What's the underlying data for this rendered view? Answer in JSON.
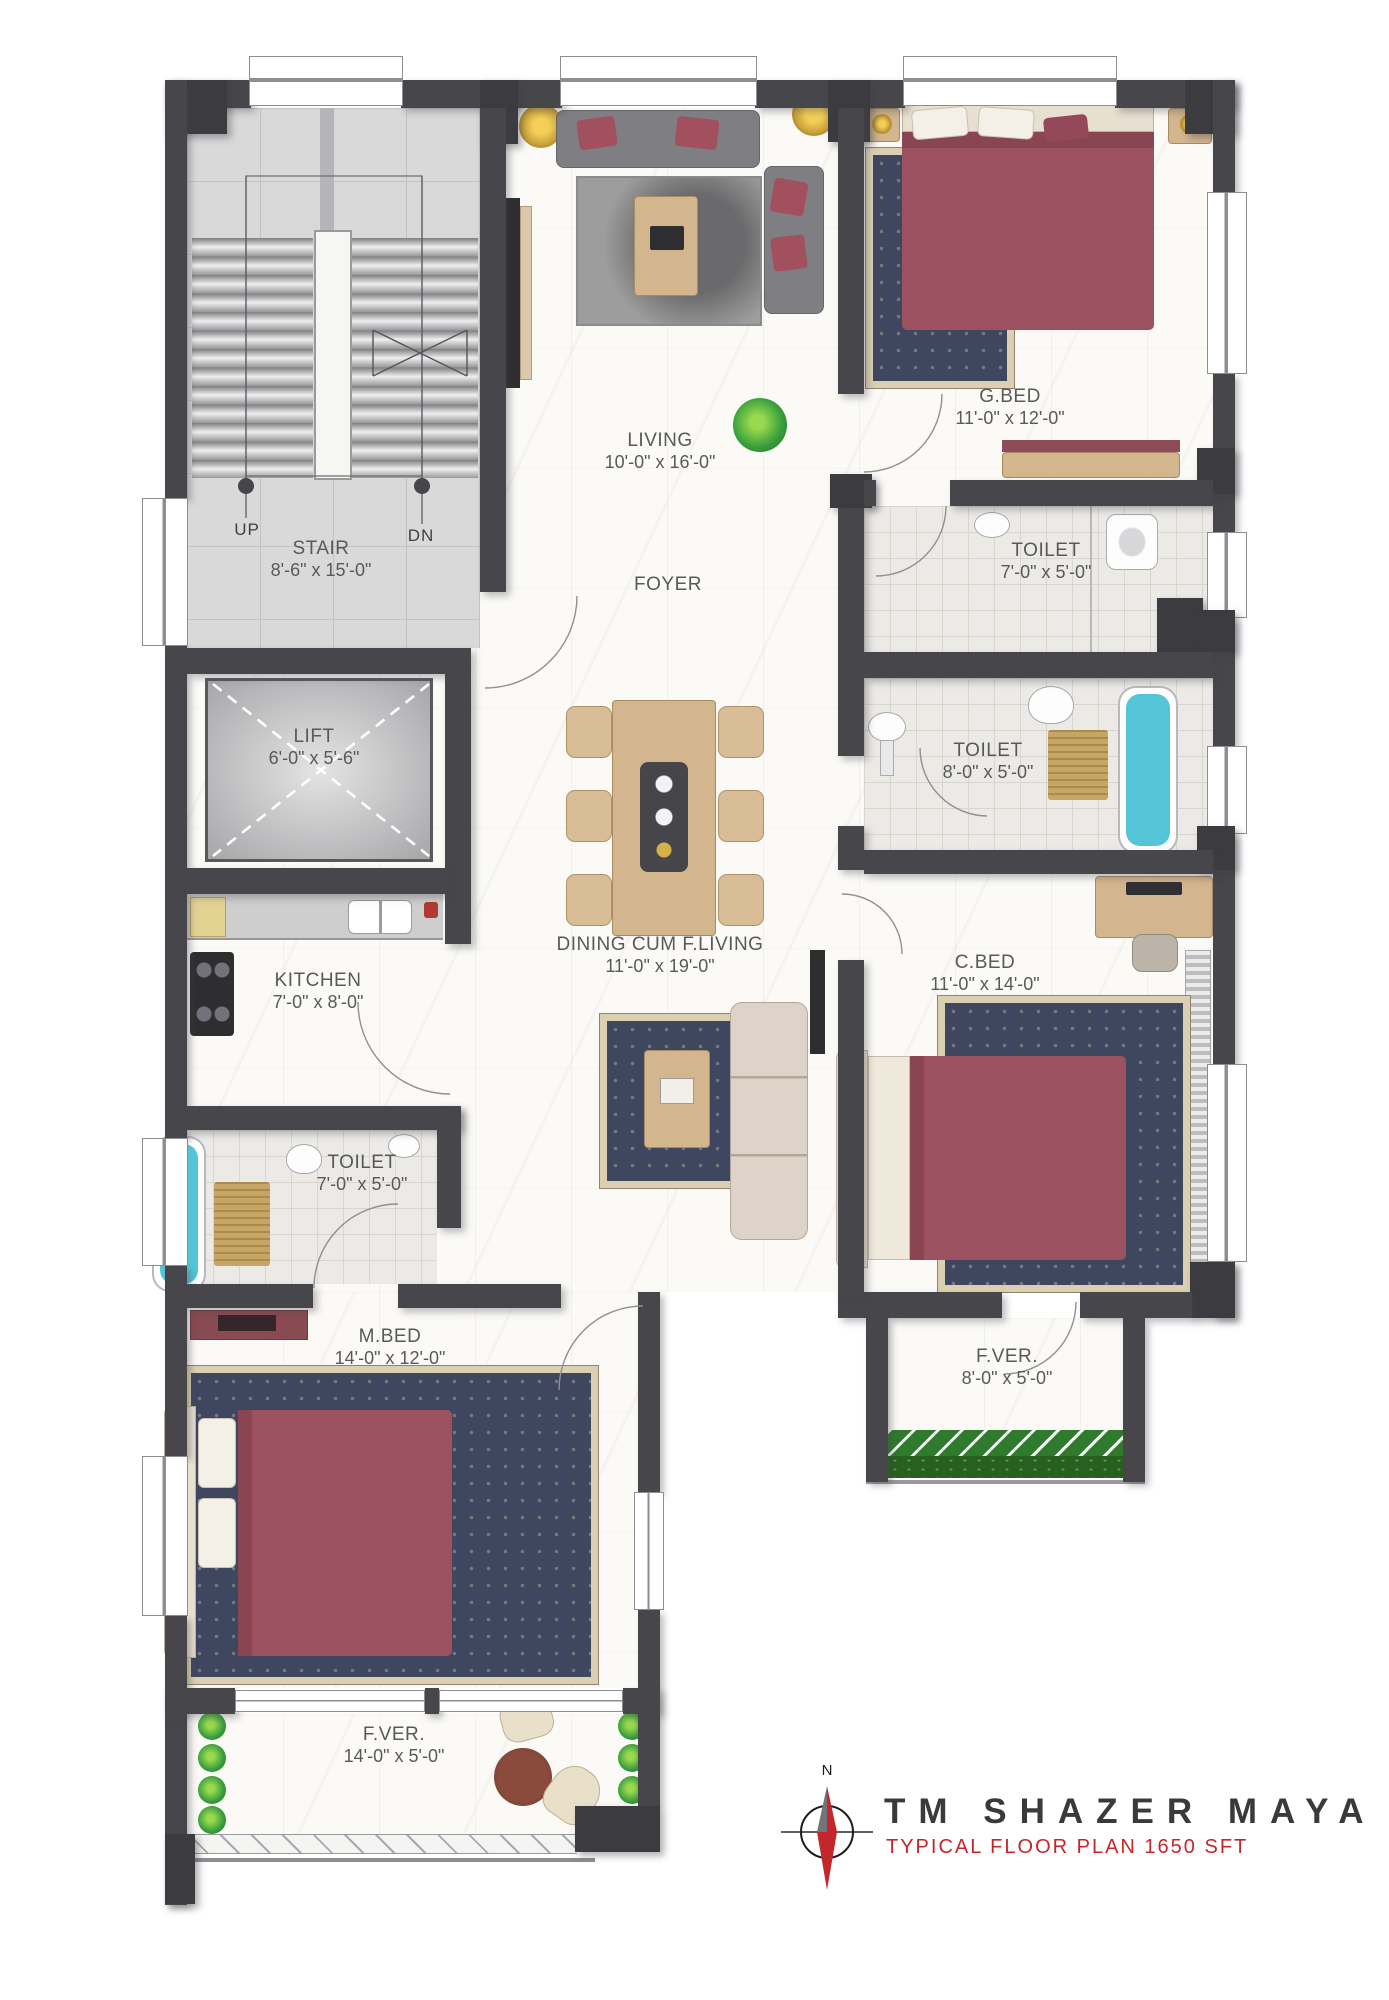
{
  "rooms": {
    "stair": {
      "label": "STAIR",
      "dims": "8'-6\" x 15'-0\"",
      "up": "UP",
      "dn": "DN"
    },
    "living": {
      "label": "LIVING",
      "dims": "10'-0\" x 16'-0\""
    },
    "gbed": {
      "label": "G.BED",
      "dims": "11'-0\" x 12'-0\""
    },
    "toilet_gbed": {
      "label": "TOILET",
      "dims": "7'-0\" x 5'-0\""
    },
    "foyer": {
      "label": "FOYER"
    },
    "lift": {
      "label": "LIFT",
      "dims": "6'-0\" x 5'-6\""
    },
    "toilet_cbed": {
      "label": "TOILET",
      "dims": "8'-0\" x 5'-0\""
    },
    "dining": {
      "label": "DINING CUM F.LIVING",
      "dims": "11'-0\" x 19'-0\""
    },
    "kitchen": {
      "label": "KITCHEN",
      "dims": "7'-0\" x 8'-0\""
    },
    "cbed": {
      "label": "C.BED",
      "dims": "11'-0\" x 14'-0\""
    },
    "toilet_mbed": {
      "label": "TOILET",
      "dims": "7'-0\" x 5'-0\""
    },
    "mbed": {
      "label": "M.BED",
      "dims": "14'-0\" x 12'-0\""
    },
    "fver_right": {
      "label": "F.VER.",
      "dims": "8'-0\" x 5'-0\""
    },
    "fver_bottom": {
      "label": "F.VER.",
      "dims": "14'-0\" x 5'-0\""
    }
  },
  "title_block": {
    "project": "TM SHAZER MAYA",
    "subtitle": "TYPICAL FLOOR PLAN 1650 SFT",
    "compass_north": "N"
  },
  "colors": {
    "wall": "#47474b",
    "accent_red": "#c4272b",
    "bed_maroon": "#9b5160",
    "tub_teal": "#55c4d7",
    "label_text": "#58595b"
  }
}
